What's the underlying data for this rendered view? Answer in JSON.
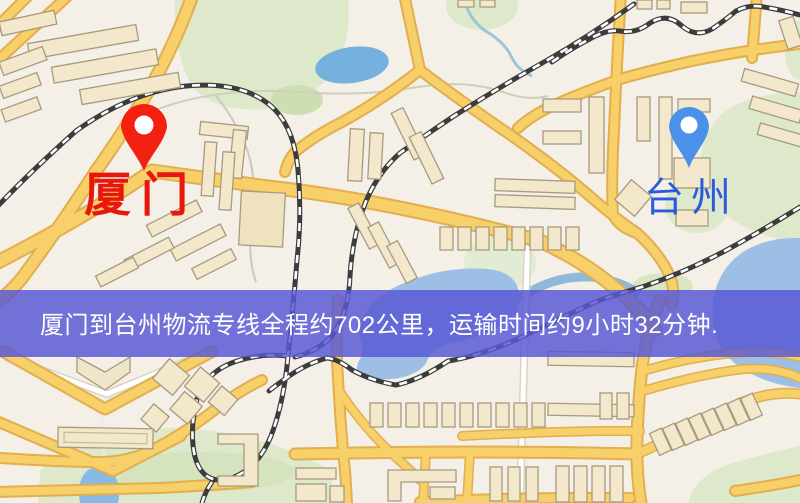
{
  "map": {
    "markers": {
      "origin": {
        "label": "厦门",
        "label_color": "#e8170b",
        "pin_color": "#f32110"
      },
      "destination": {
        "label": "台州",
        "label_color": "#2b5ce0",
        "pin_color": "#4a92e8"
      }
    },
    "banner": {
      "text": "厦门到台州物流专线全程约702公里，运输时间约9小时32分钟.",
      "background": "#5858d4",
      "text_color": "#ffffff"
    },
    "colors": {
      "background": "#f4efe7",
      "road": "#f7d06a",
      "road_casing": "#e2ae4e",
      "minor_road": "#ffffff",
      "park": "#dee9cb",
      "water": "#9dbee5",
      "lake": "#74b1df",
      "railway": "#3c3c3c",
      "building": "#f3e8cb"
    }
  }
}
